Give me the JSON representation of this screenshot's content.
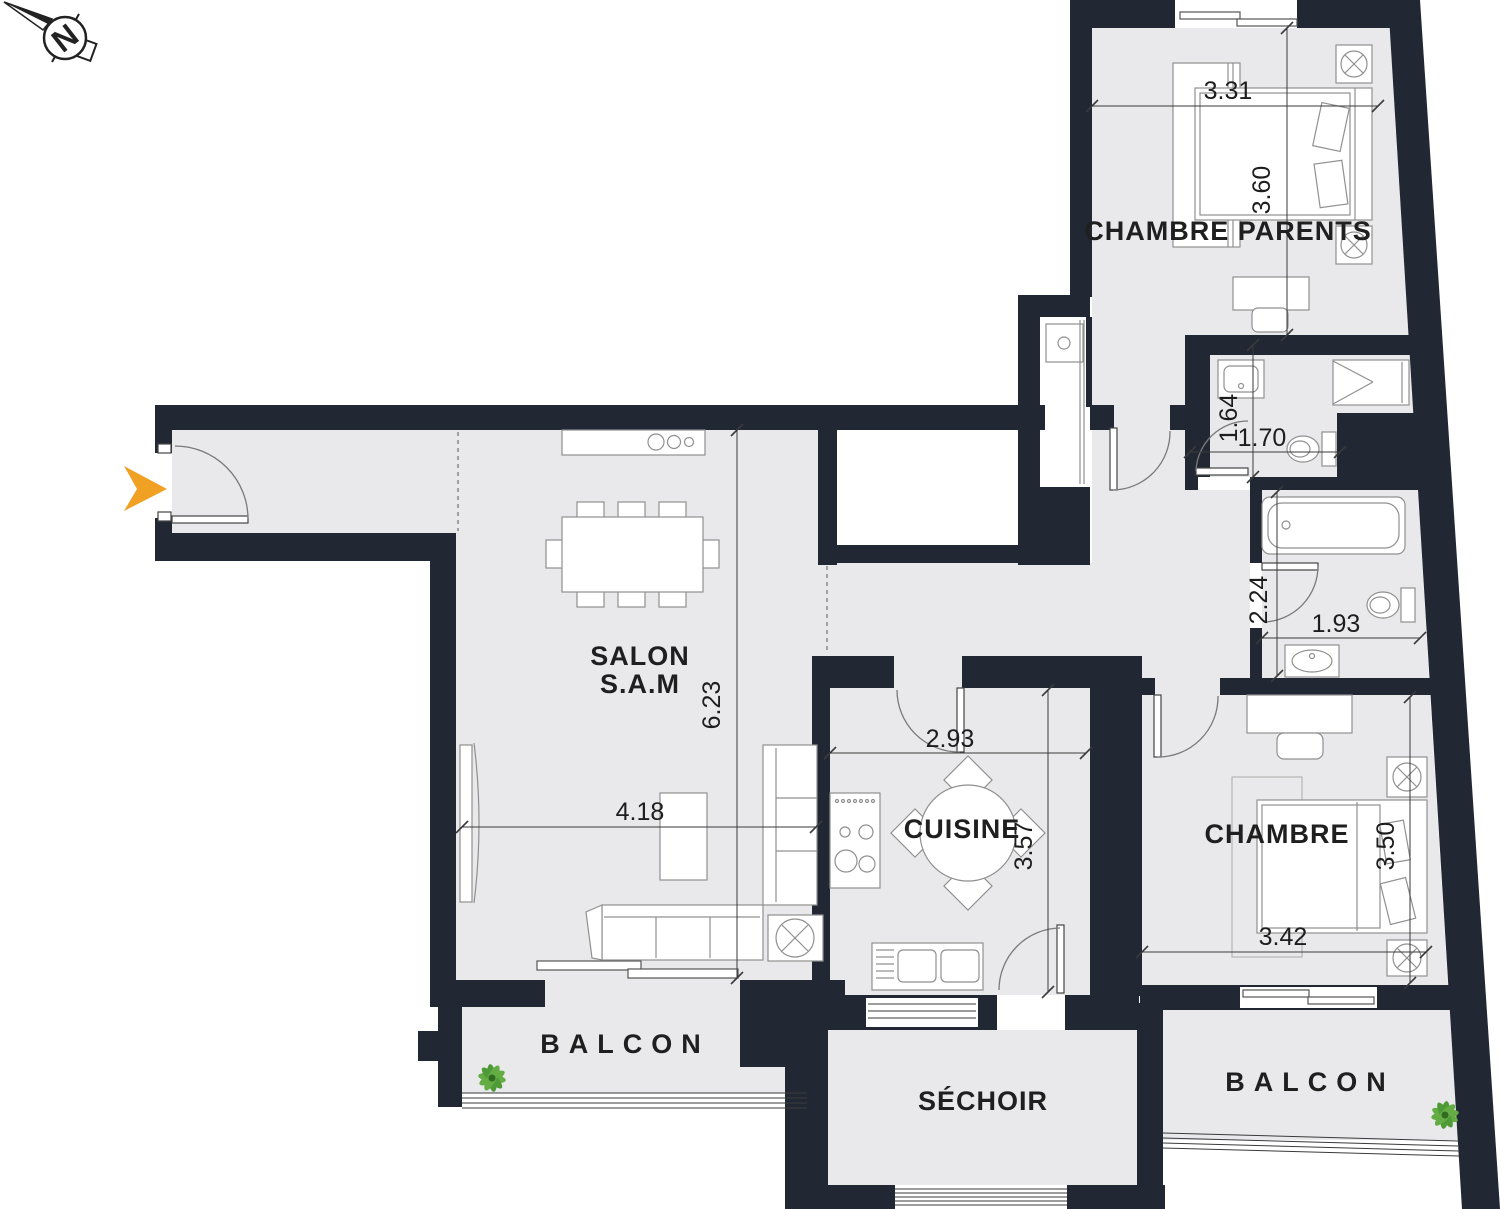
{
  "theme": {
    "wall": "#212834",
    "floor": "#e9e9eb",
    "white": "#ffffff",
    "line": "#909090",
    "dim": "#3a3a3a",
    "accent_orange": "#f0a124",
    "plant_green": "#63ad44",
    "plant_dark": "#2f6b21",
    "text": "#262626"
  },
  "compass": {
    "label": "N"
  },
  "rooms": {
    "chambre_parents": {
      "label": "CHAMBRE PARENTS",
      "width": "3.31",
      "height": "3.60"
    },
    "bathroom_top": {
      "width": "1.70",
      "height": "1.64"
    },
    "bathroom_bottom": {
      "width": "1.93",
      "height": "2.24"
    },
    "salon": {
      "label_line1": "SALON",
      "label_line2": "S.A.M",
      "width": "4.18",
      "height": "6.23"
    },
    "cuisine": {
      "label": "CUISINE",
      "width": "2.93",
      "height": "3.57"
    },
    "chambre": {
      "label": "CHAMBRE",
      "width": "3.42",
      "height": "3.50"
    },
    "sechoir": {
      "label": "SÉCHOIR"
    },
    "balcon_left": {
      "label": "BALCON"
    },
    "balcon_right": {
      "label": "BALCON"
    }
  }
}
